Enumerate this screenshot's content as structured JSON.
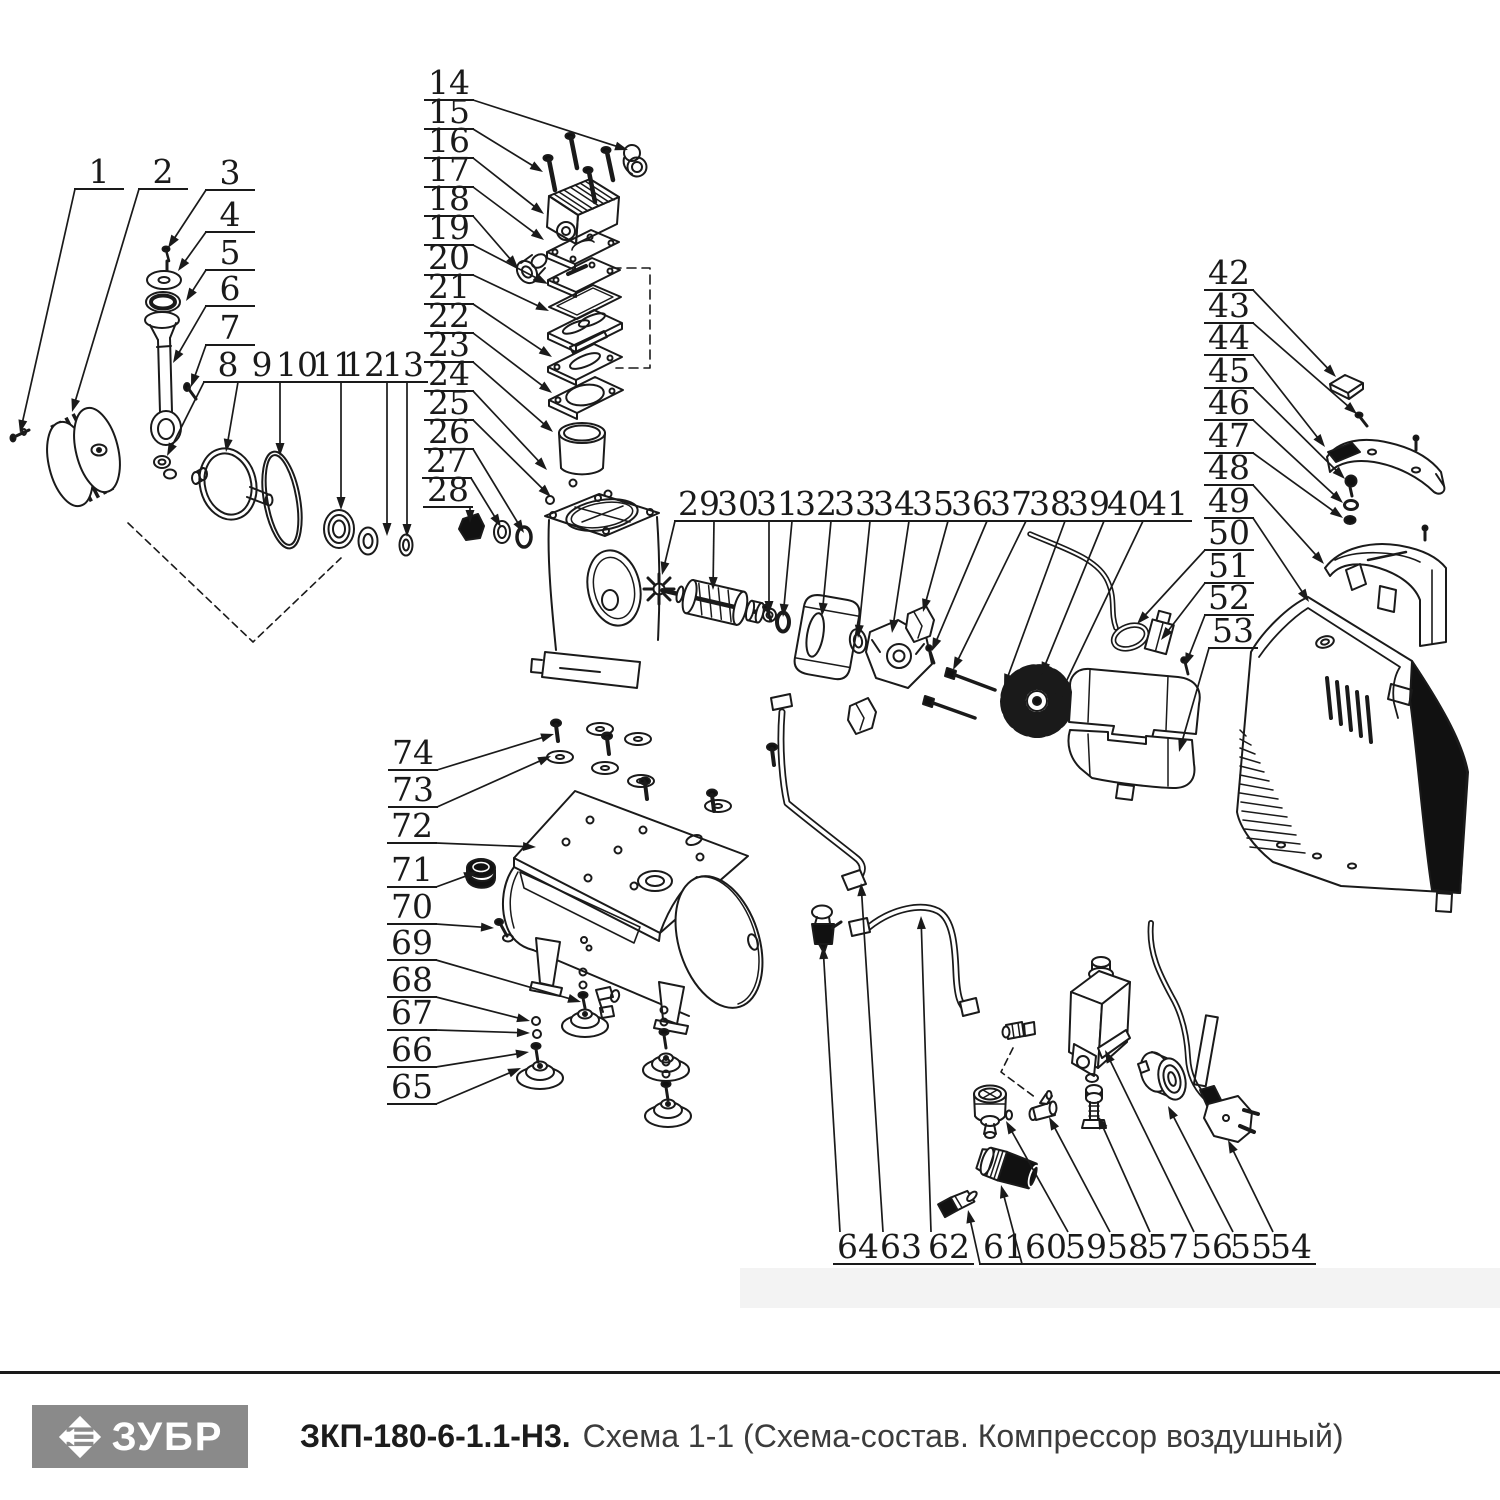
{
  "footer": {
    "logo_text": "ЗУБР",
    "logo_bg": "#8a8a8a",
    "doc_code": "ЗКП-180-6-1.1-Н3.",
    "doc_title": "Схема 1-1 (Схема-состав. Компрессор воздушный)"
  },
  "diagram": {
    "line_color": "#1a1a1a",
    "label_font_px": 33,
    "parts": [
      {
        "n": 1,
        "lx": 99,
        "ly": 172,
        "tx": 20,
        "ty": 433
      },
      {
        "n": 2,
        "lx": 163,
        "ly": 172,
        "tx": 72,
        "ty": 412
      },
      {
        "n": 3,
        "lx": 230,
        "ly": 173,
        "tx": 168,
        "ty": 248
      },
      {
        "n": 4,
        "lx": 230,
        "ly": 215,
        "tx": 178,
        "ty": 271
      },
      {
        "n": 5,
        "lx": 230,
        "ly": 253,
        "tx": 186,
        "ty": 301
      },
      {
        "n": 6,
        "lx": 230,
        "ly": 289,
        "tx": 173,
        "ty": 363
      },
      {
        "n": 7,
        "lx": 230,
        "ly": 328,
        "tx": 191,
        "ty": 387
      },
      {
        "n": 8,
        "lx": 228,
        "ly": 365,
        "tx": 167,
        "ty": 456
      },
      {
        "n": 9,
        "lx": 262,
        "ly": 365,
        "tx": 226,
        "ty": 452
      },
      {
        "n": 10,
        "lx": 297,
        "ly": 365,
        "tx": 280,
        "ty": 456
      },
      {
        "n": 11,
        "lx": 333,
        "ly": 365,
        "tx": 341,
        "ty": 510
      },
      {
        "n": 12,
        "lx": 364,
        "ly": 365,
        "tx": 387,
        "ty": 536
      },
      {
        "n": 13,
        "lx": 403,
        "ly": 365,
        "tx": 407,
        "ty": 537
      },
      {
        "n": 14,
        "lx": 449,
        "ly": 83,
        "tx": 628,
        "ty": 150
      },
      {
        "n": 15,
        "lx": 449,
        "ly": 112,
        "tx": 543,
        "ty": 172
      },
      {
        "n": 16,
        "lx": 449,
        "ly": 141,
        "tx": 544,
        "ty": 214
      },
      {
        "n": 17,
        "lx": 449,
        "ly": 170,
        "tx": 544,
        "ty": 240
      },
      {
        "n": 18,
        "lx": 449,
        "ly": 199,
        "tx": 518,
        "ty": 268
      },
      {
        "n": 19,
        "lx": 449,
        "ly": 228,
        "tx": 548,
        "ty": 284
      },
      {
        "n": 20,
        "lx": 449,
        "ly": 258,
        "tx": 549,
        "ty": 311
      },
      {
        "n": 21,
        "lx": 449,
        "ly": 287,
        "tx": 552,
        "ty": 357
      },
      {
        "n": 22,
        "lx": 449,
        "ly": 316,
        "tx": 552,
        "ty": 393
      },
      {
        "n": 23,
        "lx": 449,
        "ly": 345,
        "tx": 553,
        "ty": 432
      },
      {
        "n": 24,
        "lx": 449,
        "ly": 374,
        "tx": 547,
        "ty": 470
      },
      {
        "n": 25,
        "lx": 449,
        "ly": 403,
        "tx": 551,
        "ty": 497
      },
      {
        "n": 26,
        "lx": 449,
        "ly": 432,
        "tx": 524,
        "ty": 533
      },
      {
        "n": 27,
        "lx": 447,
        "ly": 461,
        "tx": 501,
        "ty": 527
      },
      {
        "n": 28,
        "lx": 448,
        "ly": 490,
        "tx": 470,
        "ty": 523
      },
      {
        "n": 29,
        "lx": 699,
        "ly": 504,
        "tx": 662,
        "ty": 575
      },
      {
        "n": 30,
        "lx": 738,
        "ly": 504,
        "tx": 713,
        "ty": 590
      },
      {
        "n": 31,
        "lx": 777,
        "ly": 504,
        "tx": 769,
        "ty": 614
      },
      {
        "n": 32,
        "lx": 816,
        "ly": 504,
        "tx": 783,
        "ty": 617
      },
      {
        "n": 33,
        "lx": 855,
        "ly": 504,
        "tx": 822,
        "ty": 616
      },
      {
        "n": 34,
        "lx": 894,
        "ly": 504,
        "tx": 858,
        "ty": 638
      },
      {
        "n": 35,
        "lx": 933,
        "ly": 504,
        "tx": 892,
        "ty": 633
      },
      {
        "n": 36,
        "lx": 972,
        "ly": 504,
        "tx": 923,
        "ty": 612
      },
      {
        "n": 37,
        "lx": 1011,
        "ly": 504,
        "tx": 932,
        "ty": 651
      },
      {
        "n": 38,
        "lx": 1050,
        "ly": 504,
        "tx": 953,
        "ty": 670
      },
      {
        "n": 39,
        "lx": 1089,
        "ly": 504,
        "tx": 1004,
        "ty": 687
      },
      {
        "n": 40,
        "lx": 1128,
        "ly": 504,
        "tx": 1041,
        "ty": 675
      },
      {
        "n": 41,
        "lx": 1167,
        "ly": 504,
        "tx": 1054,
        "ty": 707
      },
      {
        "n": 42,
        "lx": 1229,
        "ly": 273,
        "tx": 1336,
        "ty": 377
      },
      {
        "n": 43,
        "lx": 1229,
        "ly": 306,
        "tx": 1357,
        "ty": 414
      },
      {
        "n": 44,
        "lx": 1229,
        "ly": 338,
        "tx": 1325,
        "ty": 447
      },
      {
        "n": 45,
        "lx": 1229,
        "ly": 371,
        "tx": 1345,
        "ty": 479
      },
      {
        "n": 46,
        "lx": 1229,
        "ly": 403,
        "tx": 1343,
        "ty": 503
      },
      {
        "n": 47,
        "lx": 1229,
        "ly": 436,
        "tx": 1343,
        "ty": 518
      },
      {
        "n": 48,
        "lx": 1229,
        "ly": 468,
        "tx": 1324,
        "ty": 564
      },
      {
        "n": 49,
        "lx": 1229,
        "ly": 501,
        "tx": 1309,
        "ty": 602
      },
      {
        "n": 50,
        "lx": 1229,
        "ly": 533,
        "tx": 1137,
        "ty": 624
      },
      {
        "n": 51,
        "lx": 1229,
        "ly": 566,
        "tx": 1161,
        "ty": 640
      },
      {
        "n": 52,
        "lx": 1229,
        "ly": 598,
        "tx": 1185,
        "ty": 666
      },
      {
        "n": 53,
        "lx": 1233,
        "ly": 631,
        "tx": 1179,
        "ty": 752
      },
      {
        "n": 54,
        "lx": 1291,
        "ly": 1247,
        "tx": 1228,
        "ty": 1140
      },
      {
        "n": 55,
        "lx": 1251,
        "ly": 1247,
        "tx": 1168,
        "ty": 1106
      },
      {
        "n": 56,
        "lx": 1212,
        "ly": 1247,
        "tx": 1105,
        "ty": 1050
      },
      {
        "n": 57,
        "lx": 1168,
        "ly": 1247,
        "tx": 1098,
        "ty": 1116
      },
      {
        "n": 58,
        "lx": 1128,
        "ly": 1247,
        "tx": 1049,
        "ty": 1117
      },
      {
        "n": 59,
        "lx": 1086,
        "ly": 1247,
        "tx": 1006,
        "ty": 1121
      },
      {
        "n": 60,
        "lx": 1046,
        "ly": 1247,
        "tx": 1001,
        "ty": 1185
      },
      {
        "n": 61,
        "lx": 1004,
        "ly": 1247,
        "tx": 968,
        "ty": 1210
      },
      {
        "n": 62,
        "lx": 949,
        "ly": 1247,
        "tx": 921,
        "ty": 916
      },
      {
        "n": 63,
        "lx": 901,
        "ly": 1247,
        "tx": 861,
        "ty": 883
      },
      {
        "n": 64,
        "lx": 858,
        "ly": 1247,
        "tx": 823,
        "ty": 946
      },
      {
        "n": 65,
        "lx": 412,
        "ly": 1087,
        "tx": 521,
        "ty": 1068
      },
      {
        "n": 66,
        "lx": 412,
        "ly": 1050,
        "tx": 529,
        "ty": 1052
      },
      {
        "n": 67,
        "lx": 412,
        "ly": 1013,
        "tx": 530,
        "ty": 1033
      },
      {
        "n": 68,
        "lx": 412,
        "ly": 980,
        "tx": 530,
        "ty": 1021
      },
      {
        "n": 69,
        "lx": 412,
        "ly": 943,
        "tx": 581,
        "ty": 1002
      },
      {
        "n": 70,
        "lx": 412,
        "ly": 907,
        "tx": 494,
        "ty": 928
      },
      {
        "n": 71,
        "lx": 412,
        "ly": 870,
        "tx": 477,
        "ty": 872
      },
      {
        "n": 72,
        "lx": 412,
        "ly": 826,
        "tx": 536,
        "ty": 847
      },
      {
        "n": 73,
        "lx": 413,
        "ly": 790,
        "tx": 551,
        "ty": 756
      },
      {
        "n": 74,
        "lx": 413,
        "ly": 753,
        "tx": 554,
        "ty": 734
      }
    ]
  }
}
